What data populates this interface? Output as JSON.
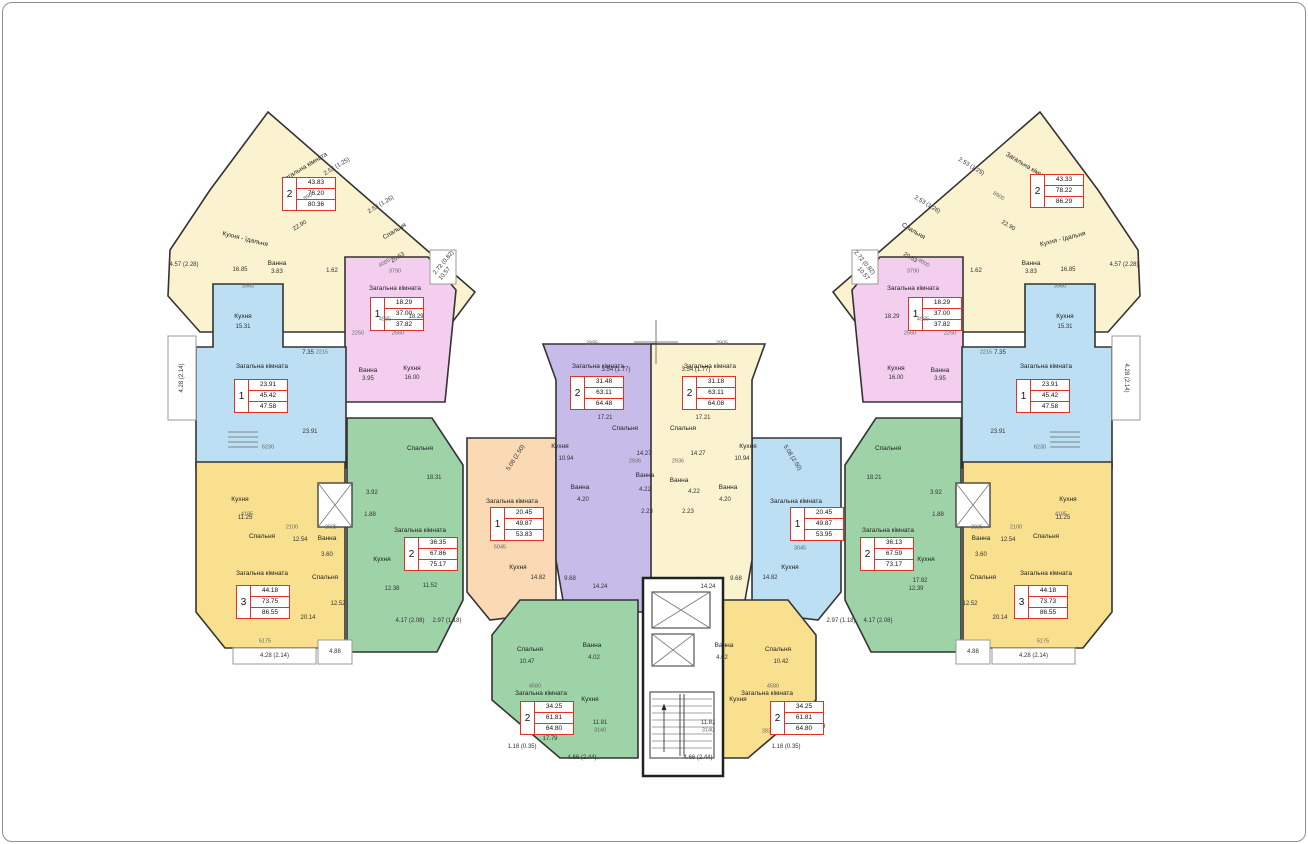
{
  "title": "Поверховий план багатоквартирного будинку",
  "colors": {
    "wall": "#333333",
    "cream": "#fbf2cf",
    "yellow": "#f8e08f",
    "pink": "#f4ceef",
    "blue": "#bcdff4",
    "blue2": "#d3eaf8",
    "green": "#9dd3a6",
    "purple": "#c7bbe9",
    "orange": "#fad9b5",
    "orange2": "#fbe7d3",
    "balcony_stroke": "#9a9a9a",
    "info_border": "#e03228"
  },
  "room_names": [
    "Загальна кімната",
    "Спальня",
    "Кухня",
    "Кухня - їдальня",
    "Ванна"
  ],
  "apartments": [
    {
      "id": "a1-wing-left",
      "color": "cream",
      "pts": "268,112 475,292 445,332 200,332 168,296 170,250 210,190",
      "info": {
        "rooms": "2",
        "values": [
          "43.83",
          "76.20",
          "80.36"
        ],
        "x": 282,
        "y": 177
      },
      "labels": [
        [
          "Загальна кімната",
          305,
          168,
          -31
        ],
        [
          "Спальня",
          395,
          232,
          -31
        ],
        [
          "Кухня - їдальня",
          245,
          240,
          14
        ],
        [
          "Ванна",
          277,
          264
        ],
        [
          "3.83",
          277,
          272
        ],
        [
          "16.85",
          240,
          270
        ],
        [
          "1.62",
          332,
          271
        ],
        [
          "10.57",
          445,
          274,
          -50
        ]
      ]
    },
    {
      "id": "a14-wing-right",
      "color": "cream",
      "pts": "1040,112 833,292 863,332 1108,332 1140,296 1138,250 1098,190",
      "info": {
        "rooms": "2",
        "values": [
          "43.33",
          "78.22",
          "86.29"
        ],
        "x": 1030,
        "y": 174
      },
      "labels": [
        [
          "Загальна кімната",
          1028,
          168,
          31
        ],
        [
          "Спальня",
          913,
          232,
          31
        ],
        [
          "Кухня - їдальня",
          1063,
          240,
          -14
        ],
        [
          "Ванна",
          1031,
          264
        ],
        [
          "3.83",
          1031,
          272
        ],
        [
          "16.85",
          1068,
          270
        ],
        [
          "1.62",
          976,
          271
        ],
        [
          "10.57",
          863,
          274,
          50
        ]
      ]
    },
    {
      "id": "a2-pink-left",
      "color": "pink",
      "pts": "345,257 428,257 456,290 445,402 345,402",
      "info": {
        "rooms": "1",
        "values": [
          "18.29",
          "37.00",
          "37.82"
        ],
        "x": 370,
        "y": 297
      },
      "labels": [
        [
          "Загальна кімната",
          395,
          289
        ],
        [
          "Ванна",
          368,
          371
        ],
        [
          "3.95",
          368,
          379
        ],
        [
          "Кухня",
          412,
          369
        ],
        [
          "16.00",
          412,
          378
        ]
      ]
    },
    {
      "id": "a12-pink-right",
      "color": "pink",
      "pts": "963,257 880,257 852,290 863,402 963,402",
      "info": {
        "rooms": "1",
        "values": [
          "18.29",
          "37.00",
          "37.82"
        ],
        "x": 908,
        "y": 297
      },
      "labels": [
        [
          "Загальна кімната",
          913,
          289
        ],
        [
          "Ванна",
          940,
          371
        ],
        [
          "3.95",
          940,
          379
        ],
        [
          "Кухня",
          896,
          369
        ],
        [
          "16.00",
          896,
          378
        ]
      ]
    },
    {
      "id": "a3-blue-left",
      "color": "blue",
      "pts": "213,284 283,284 283,347 346,347 346,468 196,468 196,347 213,347",
      "info": {
        "rooms": "1",
        "values": [
          "23.91",
          "45.42",
          "47.58"
        ],
        "x": 234,
        "y": 379
      },
      "labels": [
        [
          "Кухня",
          243,
          317
        ],
        [
          "15.31",
          243,
          327
        ],
        [
          "Загальна кімната",
          262,
          367
        ],
        [
          "23.91",
          310,
          432
        ]
      ]
    },
    {
      "id": "a13-blue-right",
      "color": "blue",
      "pts": "1095,284 1025,284 1025,347 962,347 962,468 1112,468 1112,347 1095,347",
      "info": {
        "rooms": "1",
        "values": [
          "23.91",
          "45.42",
          "47.58"
        ],
        "x": 1016,
        "y": 379
      },
      "labels": [
        [
          "Кухня",
          1065,
          317
        ],
        [
          "15.31",
          1065,
          327
        ],
        [
          "Загальна кімната",
          1046,
          367
        ],
        [
          "23.91",
          998,
          432
        ]
      ]
    },
    {
      "id": "a4-yellow-left",
      "color": "yellow",
      "pts": "196,462 345,462 345,648 225,648 196,612",
      "info": {
        "rooms": "3",
        "values": [
          "44.18",
          "73.75",
          "86.55"
        ],
        "x": 236,
        "y": 585
      },
      "labels": [
        [
          "Кухня",
          240,
          500
        ],
        [
          "11.25",
          245,
          518
        ],
        [
          "Спальня",
          262,
          537
        ],
        [
          "12.54",
          300,
          540
        ],
        [
          "Ванна",
          327,
          539
        ],
        [
          "3.60",
          327,
          555
        ],
        [
          "Загальна кімната",
          262,
          574
        ],
        [
          "20.14",
          308,
          618
        ],
        [
          "Спальня",
          325,
          578
        ],
        [
          "12.52",
          338,
          604
        ]
      ]
    },
    {
      "id": "a11-yellow-right",
      "color": "yellow",
      "pts": "1112,462 963,462 963,648 1083,648 1112,612",
      "info": {
        "rooms": "3",
        "values": [
          "44.18",
          "73.73",
          "86.55"
        ],
        "x": 1014,
        "y": 585
      },
      "labels": [
        [
          "Кухня",
          1068,
          500
        ],
        [
          "11.25",
          1063,
          518
        ],
        [
          "Спальня",
          1046,
          537
        ],
        [
          "12.54",
          1008,
          540
        ],
        [
          "Ванна",
          981,
          539
        ],
        [
          "3.60",
          981,
          555
        ],
        [
          "Загальна кімната",
          1046,
          574
        ],
        [
          "20.14",
          1000,
          618
        ],
        [
          "Спальня",
          983,
          578
        ],
        [
          "12.52",
          970,
          604
        ]
      ]
    },
    {
      "id": "a5-green-left",
      "color": "green",
      "pts": "347,418 432,418 463,465 463,600 437,652 347,652",
      "info": {
        "rooms": "2",
        "values": [
          "36.35",
          "67.86",
          "75.17"
        ],
        "x": 404,
        "y": 537
      },
      "labels": [
        [
          "Спальня",
          420,
          449
        ],
        [
          "18.31",
          434,
          478
        ],
        [
          "Загальна кімната",
          420,
          531
        ],
        [
          "Кухня",
          382,
          560
        ],
        [
          "12.38",
          392,
          589
        ],
        [
          "11.52",
          430,
          586
        ],
        [
          "3.92",
          372,
          493
        ],
        [
          "1.88",
          370,
          515
        ]
      ]
    },
    {
      "id": "a10-green-right",
      "color": "green",
      "pts": "961,418 876,418 845,465 845,600 871,652 961,652",
      "info": {
        "rooms": "2",
        "values": [
          "36.13",
          "67.59",
          "73.17"
        ],
        "x": 860,
        "y": 537
      },
      "labels": [
        [
          "Спальня",
          888,
          449
        ],
        [
          "18.21",
          874,
          478
        ],
        [
          "Загальна кімната",
          888,
          531
        ],
        [
          "Кухня",
          926,
          560
        ],
        [
          "12.39",
          916,
          589
        ],
        [
          "17.82",
          920,
          581
        ],
        [
          "3.92",
          936,
          493
        ],
        [
          "1.88",
          938,
          515
        ]
      ]
    },
    {
      "id": "a6-orange-center-left",
      "color": "orange",
      "pts": "467,438 556,438 556,612 490,620 467,592",
      "info": {
        "rooms": "1",
        "values": [
          "20.45",
          "49.87",
          "53.83"
        ],
        "x": 490,
        "y": 507
      },
      "labels": [
        [
          "Загальна кімната",
          512,
          502
        ],
        [
          "20.45",
          536,
          519
        ],
        [
          "Кухня",
          518,
          568
        ],
        [
          "14.82",
          538,
          578
        ],
        [
          "9.68",
          570,
          579
        ],
        [
          "5045",
          500,
          548
        ]
      ]
    },
    {
      "id": "a6-bath",
      "color": "orange2",
      "sub": true,
      "pts": "560,478 600,478 600,542 560,542",
      "labels": [
        [
          "Ванна",
          580,
          488
        ],
        [
          "4.20",
          583,
          500
        ]
      ]
    },
    {
      "id": "a9-blue-center-right",
      "color": "blue",
      "pts": "841,438 752,438 752,612 818,620 841,592",
      "info": {
        "rooms": "1",
        "values": [
          "20.45",
          "49.87",
          "53.95"
        ],
        "x": 790,
        "y": 507
      },
      "labels": [
        [
          "Загальна кімната",
          796,
          502
        ],
        [
          "20.45",
          824,
          540
        ],
        [
          "Кухня",
          790,
          568
        ],
        [
          "14.82",
          770,
          578
        ],
        [
          "9.68",
          736,
          579
        ],
        [
          "3045",
          800,
          549
        ]
      ]
    },
    {
      "id": "a9-bath",
      "color": "blue2",
      "sub": true,
      "pts": "708,478 748,478 748,542 708,542",
      "labels": [
        [
          "Ванна",
          728,
          488
        ],
        [
          "4.20",
          725,
          500
        ]
      ]
    },
    {
      "id": "a7-purple-center",
      "color": "purple",
      "pts": "543,344 657,344 657,612 565,612 556,560 556,380",
      "info": {
        "rooms": "2",
        "values": [
          "31.48",
          "63.11",
          "64.48"
        ],
        "x": 570,
        "y": 376
      },
      "labels": [
        [
          "Загальна кімната",
          598,
          367
        ],
        [
          "Кухня",
          560,
          447
        ],
        [
          "10.94",
          566,
          459
        ],
        [
          "Спальня",
          625,
          429
        ],
        [
          "17.21",
          605,
          418
        ],
        [
          "Ванна",
          645,
          476
        ],
        [
          "4.22",
          645,
          490
        ],
        [
          "2.23",
          647,
          512
        ],
        [
          "14.27",
          644,
          454
        ],
        [
          "2936",
          635,
          462
        ],
        [
          "14.24",
          600,
          587
        ]
      ]
    },
    {
      "id": "a8-cream-center",
      "color": "cream",
      "pts": "765,344 651,344 651,612 743,612 752,560 752,380",
      "info": {
        "rooms": "2",
        "values": [
          "31.18",
          "63.11",
          "64.08"
        ],
        "x": 682,
        "y": 376
      },
      "labels": [
        [
          "Загальна кімната",
          710,
          367
        ],
        [
          "Кухня",
          748,
          447
        ],
        [
          "10.94",
          742,
          459
        ],
        [
          "Спальня",
          683,
          429
        ],
        [
          "17.21",
          703,
          418
        ],
        [
          "Ванна",
          679,
          481
        ],
        [
          "4.22",
          694,
          492
        ],
        [
          "2.23",
          688,
          512
        ],
        [
          "14.27",
          698,
          454
        ],
        [
          "2936",
          678,
          462
        ],
        [
          "14.24",
          708,
          587
        ]
      ]
    },
    {
      "id": "a15-green-bottom",
      "color": "green",
      "pts": "520,600 638,600 638,758 560,758 492,700 492,635",
      "info": {
        "rooms": "2",
        "values": [
          "34.25",
          "61.81",
          "64.80"
        ],
        "x": 520,
        "y": 701
      },
      "labels": [
        [
          "Спальня",
          530,
          650
        ],
        [
          "10.47",
          527,
          662
        ],
        [
          "Ванна",
          592,
          646
        ],
        [
          "4.02",
          594,
          658
        ],
        [
          "Кухня",
          590,
          700
        ],
        [
          "11.81",
          600,
          723
        ],
        [
          "Загальна кімната",
          541,
          694
        ],
        [
          "17.79",
          550,
          739
        ],
        [
          "4580",
          535,
          687
        ],
        [
          "2820",
          540,
          732
        ],
        [
          "3140",
          600,
          731
        ]
      ]
    },
    {
      "id": "a16-yellow-bottom",
      "color": "yellow",
      "pts": "788,600 670,600 670,758 748,758 816,700 816,635",
      "info": {
        "rooms": "2",
        "values": [
          "34.25",
          "61.81",
          "64.80"
        ],
        "x": 770,
        "y": 701
      },
      "labels": [
        [
          "Спальня",
          778,
          650
        ],
        [
          "10.42",
          781,
          662
        ],
        [
          "Ванна",
          724,
          646
        ],
        [
          "4.02",
          722,
          658
        ],
        [
          "Кухня",
          738,
          700
        ],
        [
          "11.81",
          708,
          723
        ],
        [
          "Загальна кімната",
          767,
          694
        ],
        [
          "17.79",
          818,
          727
        ],
        [
          "4580",
          773,
          687
        ],
        [
          "2820",
          768,
          732
        ],
        [
          "3140",
          708,
          731
        ]
      ]
    }
  ],
  "balconies": [
    [
      168,
      336,
      28,
      84,
      "4.28 (2.14)",
      -90
    ],
    [
      1112,
      336,
      28,
      84,
      "4.28 (2.14)",
      90
    ],
    [
      233,
      648,
      83,
      16,
      "4.28 (2.14)",
      0
    ],
    [
      318,
      640,
      34,
      24,
      "4.88",
      0
    ],
    [
      992,
      648,
      83,
      16,
      "4.28 (2.14)",
      0
    ],
    [
      956,
      640,
      34,
      24,
      "4.88",
      0
    ],
    [
      430,
      250,
      26,
      34,
      null,
      0
    ],
    [
      852,
      250,
      26,
      34,
      null,
      0
    ]
  ],
  "annotations": [
    [
      "2.53 (1.25)",
      337,
      167,
      -31
    ],
    [
      "2.53 (1.26)",
      381,
      205,
      -31
    ],
    [
      "8900",
      310,
      197,
      -31
    ],
    [
      "22.90",
      300,
      226,
      -31
    ],
    [
      "20.53",
      398,
      258,
      -31
    ],
    [
      "4000",
      385,
      264,
      -31
    ],
    [
      "4.57 (2.28)",
      184,
      265,
      0
    ],
    [
      "2.72 (0.82)",
      444,
      263,
      -50
    ],
    [
      "2.53 (1.25)",
      971,
      167,
      31
    ],
    [
      "2.53 (1.26)",
      927,
      205,
      31
    ],
    [
      "8900",
      998,
      197,
      31
    ],
    [
      "22.90",
      1008,
      226,
      31
    ],
    [
      "20.53",
      910,
      258,
      31
    ],
    [
      "4000",
      923,
      264,
      31
    ],
    [
      "4.57 (2.28)",
      1124,
      265,
      0
    ],
    [
      "2.72 (0.82)",
      864,
      263,
      50
    ],
    [
      "3790",
      395,
      272,
      0
    ],
    [
      "4985",
      385,
      320,
      0
    ],
    [
      "18.29",
      416,
      317,
      0
    ],
    [
      "2250",
      358,
      334,
      0
    ],
    [
      "2560",
      398,
      334,
      0
    ],
    [
      "3790",
      913,
      272,
      0
    ],
    [
      "4985",
      923,
      320,
      0
    ],
    [
      "18.29",
      892,
      317,
      0
    ],
    [
      "2250",
      950,
      334,
      0
    ],
    [
      "2560",
      910,
      334,
      0
    ],
    [
      "3960",
      248,
      287,
      0
    ],
    [
      "2215",
      322,
      353,
      0
    ],
    [
      "6230",
      268,
      448,
      0
    ],
    [
      "7.35",
      308,
      353,
      0
    ],
    [
      "3960",
      1060,
      287,
      0
    ],
    [
      "2215",
      986,
      353,
      0
    ],
    [
      "6230",
      1040,
      448,
      0
    ],
    [
      "7.35",
      1000,
      353,
      0
    ],
    [
      "4185",
      247,
      515,
      0
    ],
    [
      "2100",
      292,
      528,
      0
    ],
    [
      "5175",
      265,
      642,
      0
    ],
    [
      "2025",
      331,
      528,
      0
    ],
    [
      "4185",
      1061,
      515,
      0
    ],
    [
      "2100",
      1016,
      528,
      0
    ],
    [
      "5175",
      1043,
      642,
      0
    ],
    [
      "2025",
      977,
      528,
      0
    ],
    [
      "2995",
      592,
      344,
      0
    ],
    [
      "2905",
      722,
      344,
      0
    ],
    [
      "3.54 (1.77)",
      616,
      370,
      0
    ],
    [
      "3.54 (1.77)",
      696,
      370,
      0
    ],
    [
      "5.08 (2.50)",
      516,
      458,
      -58
    ],
    [
      "5.08 (2.50)",
      792,
      458,
      58
    ],
    [
      "4.17 (2.08)",
      410,
      621,
      0
    ],
    [
      "2.97 (1.18)",
      447,
      621,
      0
    ],
    [
      "2.97 (1.18)",
      841,
      621,
      0
    ],
    [
      "4.17 (2.08)",
      878,
      621,
      0
    ],
    [
      "1.18 (0.35)",
      522,
      747,
      0
    ],
    [
      "4.66 (2.44)",
      582,
      758,
      0
    ],
    [
      "1.18 (0.35)",
      786,
      747,
      0
    ],
    [
      "4.66 (2.44)",
      698,
      758,
      0
    ]
  ]
}
